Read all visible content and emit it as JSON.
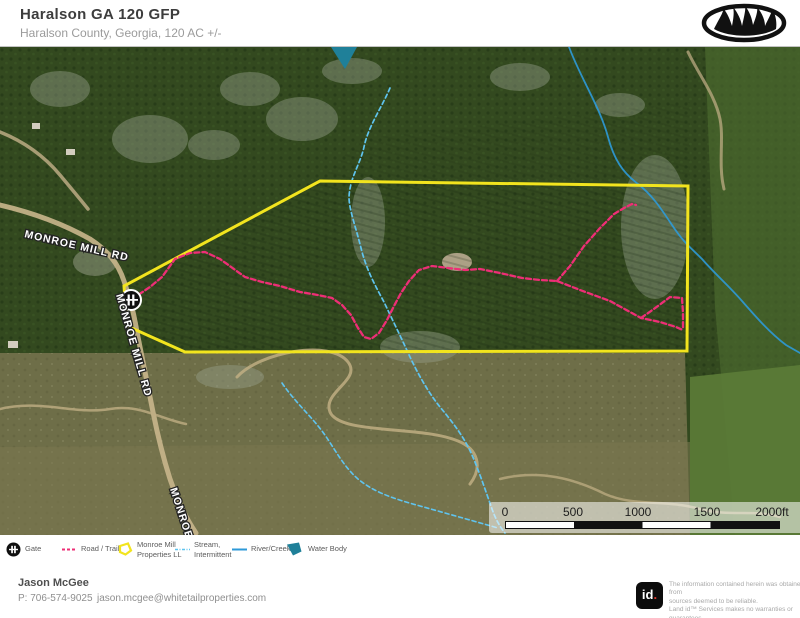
{
  "header": {
    "title": "Haralson GA 120 GFP",
    "subtitle": "Haralson County, Georgia, 120 AC +/-"
  },
  "map": {
    "road_labels": [
      "MONROE MILL RD",
      "MONROE MILL RD",
      "MONROE"
    ],
    "scale_bar": {
      "ticks": [
        "0",
        "500",
        "1000",
        "1500",
        "2000ft"
      ]
    },
    "colors": {
      "boundary": "#f2e41e",
      "trail": "#ee2e76",
      "stream": "#5fc4ef",
      "river": "#2e9ad8",
      "water": "#1f8099",
      "road": "#c9b68c"
    }
  },
  "legend": {
    "items": [
      {
        "line1": "Gate",
        "line2": ""
      },
      {
        "line1": "Road / Trail",
        "line2": ""
      },
      {
        "line1": "Monroe Mill",
        "line2": "Properties LL"
      },
      {
        "line1": "Stream,",
        "line2": "Intermittent"
      },
      {
        "line1": "River/Creek",
        "line2": ""
      },
      {
        "line1": "Water Body",
        "line2": ""
      }
    ]
  },
  "footer": {
    "agent": "Jason McGee",
    "phone": "P: 706-574-9025",
    "email": "jason.mcgee@whitetailproperties.com",
    "logo_text": "id",
    "logo_dot": ".",
    "disclaimer_lines": [
      "The information contained herein was obtained from",
      "sources deemed to be reliable.",
      "Land id™ Services makes no warranties or guarantees",
      "as to the completeness or accuracy thereof."
    ]
  }
}
